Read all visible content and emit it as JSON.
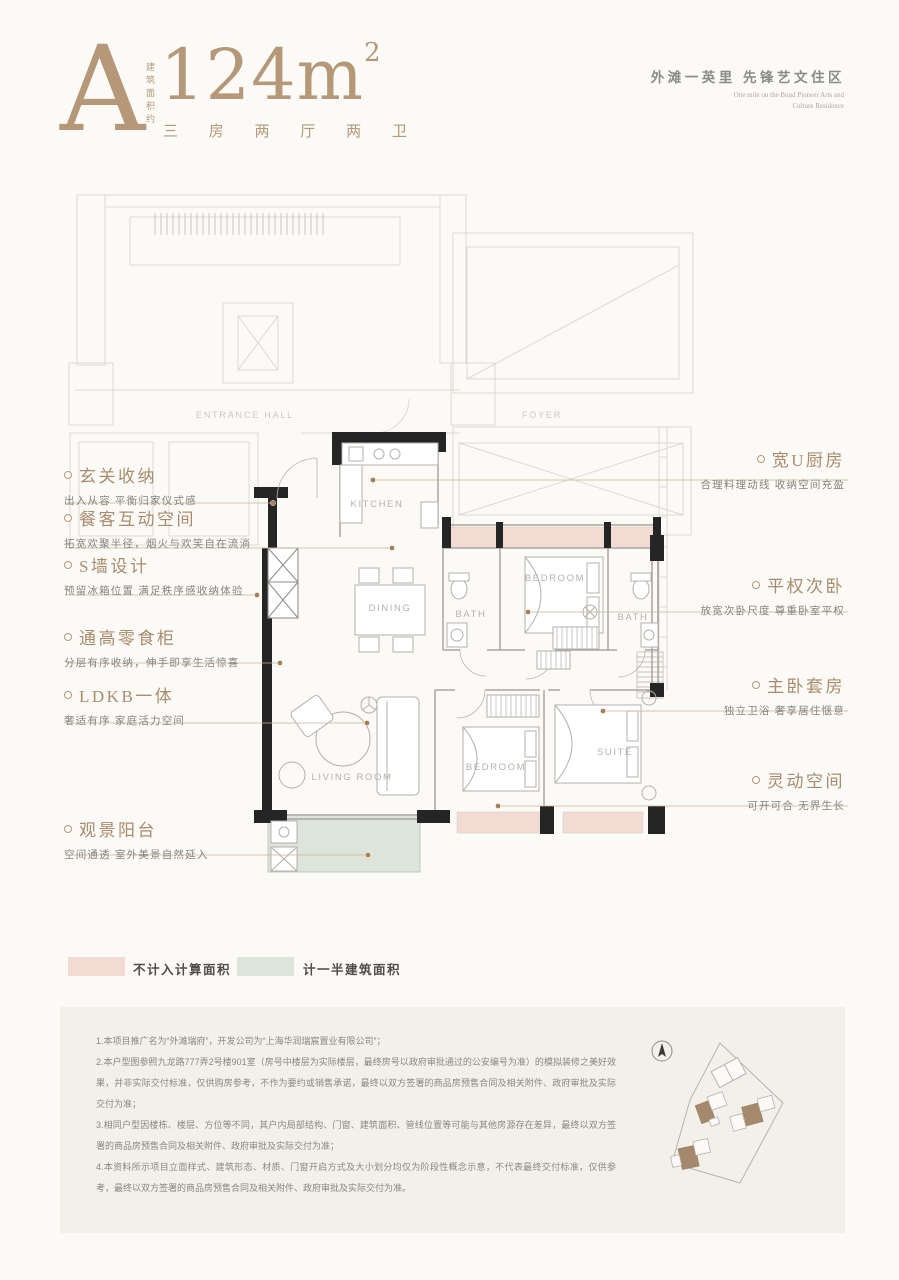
{
  "header": {
    "unit_letter": "A",
    "area_prefix_vertical": "建筑面积约",
    "area_value": "124m",
    "area_sup": "2",
    "layout_spec": "三 房 两 厅 两 卫",
    "tagline_cn": "外滩一英里  先锋艺文住区",
    "tagline_en_line1": "One mile on the Bund Pioneer Arts and",
    "tagline_en_line2": "Culture Residence"
  },
  "plan": {
    "kitchen": "KITCHEN",
    "dining": "DINING",
    "bath1": "BATH",
    "bedroom1": "BEDROOM",
    "bath2": "BATH",
    "living": "LIVING ROOM",
    "bedroom2": "BEDROOM",
    "suite": "SUITE",
    "entrance_hall": "ENTRANCE HALL",
    "foyer": "FOYER"
  },
  "annotations_left": [
    {
      "title": "玄关收纳",
      "desc": "出入从容 平衡归家仪式感"
    },
    {
      "title": "餐客互动空间",
      "desc": "拓宽欢聚半径，烟火与欢笑自在流淌"
    },
    {
      "title": "S墙设计",
      "desc": "预留冰箱位置 满足秩序感收纳体验"
    },
    {
      "title": "通高零食柜",
      "desc": "分层有序收纳，伸手即享生活惊喜"
    },
    {
      "title": "LDKB一体",
      "desc": "奢适有序 家庭活力空间"
    },
    {
      "title": "观景阳台",
      "desc": "空间通透 室外美景自然延入"
    }
  ],
  "annotations_right": [
    {
      "title": "宽U厨房",
      "desc": "合理料理动线 收纳空间充盈"
    },
    {
      "title": "平权次卧",
      "desc": "放宽次卧尺度 尊重卧室平权"
    },
    {
      "title": "主卧套房",
      "desc": "独立卫浴 奢享居住惬意"
    },
    {
      "title": "灵动空间",
      "desc": "可开可合 无界生长"
    }
  ],
  "legend": [
    {
      "label": "不计入计算面积",
      "color": "#f2dbd3"
    },
    {
      "label": "计一半建筑面积",
      "color": "#dde4da"
    }
  ],
  "disclaimer": {
    "items": [
      "1.本项目推广名为“外滩瑞府”，开发公司为“上海华润瑞宸置业有限公司”；",
      "2.本户型图参照九龙路777弄2号楼901室（房号中楼层为实际楼层，最终房号以政府审批通过的公安编号为准）的模拟装修之美好效果，并非实际交付标准，仅供购房参考，不作为要约或销售承诺，最终以双方签署的商品房预售合同及相关附件、政府审批及实际交付为准；",
      "3.相同户型因楼栋、楼层、方位等不同，其户内局部结构、门窗、建筑面积、管线位置等可能与其他房源存在差异，最终以双方签署的商品房预售合同及相关附件、政府审批及实际交付为准；",
      "4.本资料所示项目立面样式、建筑形态、材质、门窗开启方式及大小划分均仅为阶段性概念示意，不代表最终交付标准，仅供参考，最终以双方签署的商品房预售合同及相关附件、政府审批及实际交付为准。"
    ]
  },
  "colors": {
    "accent_bronze": "#b59878",
    "bay_window_pink": "#f2dbd3",
    "balcony_green": "#dde4da",
    "wall_black": "#252525",
    "site_building_brown": "#a5896c"
  }
}
